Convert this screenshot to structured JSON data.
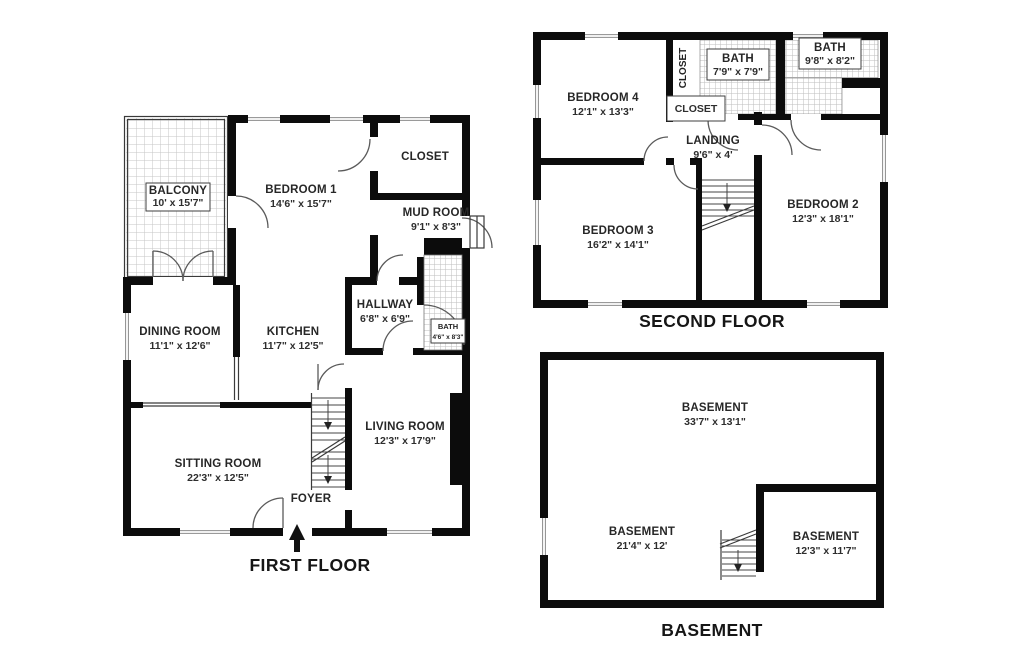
{
  "first_floor": {
    "title": "FIRST FLOOR",
    "rooms": {
      "balcony": {
        "name": "BALCONY",
        "dims": "10' x 15'7\""
      },
      "bedroom1": {
        "name": "BEDROOM 1",
        "dims": "14'6\" x 15'7\""
      },
      "closet": {
        "name": "CLOSET"
      },
      "mud_room": {
        "name": "MUD ROOM",
        "dims": "9'1\" x 8'3\""
      },
      "hallway": {
        "name": "HALLWAY",
        "dims": "6'8\" x 6'9\""
      },
      "bath": {
        "name": "BATH",
        "dims": "4'6\" x 8'3\""
      },
      "dining_room": {
        "name": "DINING ROOM",
        "dims": "11'1\" x 12'6\""
      },
      "kitchen": {
        "name": "KITCHEN",
        "dims": "11'7\" x 12'5\""
      },
      "sitting_room": {
        "name": "SITTING ROOM",
        "dims": "22'3\" x 12'5\""
      },
      "living_room": {
        "name": "LIVING ROOM",
        "dims": "12'3\" x 17'9\""
      },
      "foyer": {
        "name": "FOYER"
      }
    }
  },
  "second_floor": {
    "title": "SECOND FLOOR",
    "rooms": {
      "bedroom4": {
        "name": "BEDROOM 4",
        "dims": "12'1\" x 13'3\""
      },
      "closet_upper": {
        "name": "CLOSET"
      },
      "closet_lower": {
        "name": "CLOSET"
      },
      "bath_center": {
        "name": "BATH",
        "dims": "7'9\" x 7'9\""
      },
      "bath_right": {
        "name": "BATH",
        "dims": "9'8\" x 8'2\""
      },
      "landing": {
        "name": "LANDING",
        "dims": "9'6\" x 4'"
      },
      "bedroom3": {
        "name": "BEDROOM 3",
        "dims": "16'2\" x 14'1\""
      },
      "bedroom2": {
        "name": "BEDROOM 2",
        "dims": "12'3\" x 18'1\""
      }
    }
  },
  "basement": {
    "title": "BASEMENT",
    "rooms": {
      "basement_main": {
        "name": "BASEMENT",
        "dims": "33'7\" x 13'1\""
      },
      "basement_left": {
        "name": "BASEMENT",
        "dims": "21'4\" x 12'"
      },
      "basement_right": {
        "name": "BASEMENT",
        "dims": "12'3\" x 11'7\""
      }
    }
  }
}
